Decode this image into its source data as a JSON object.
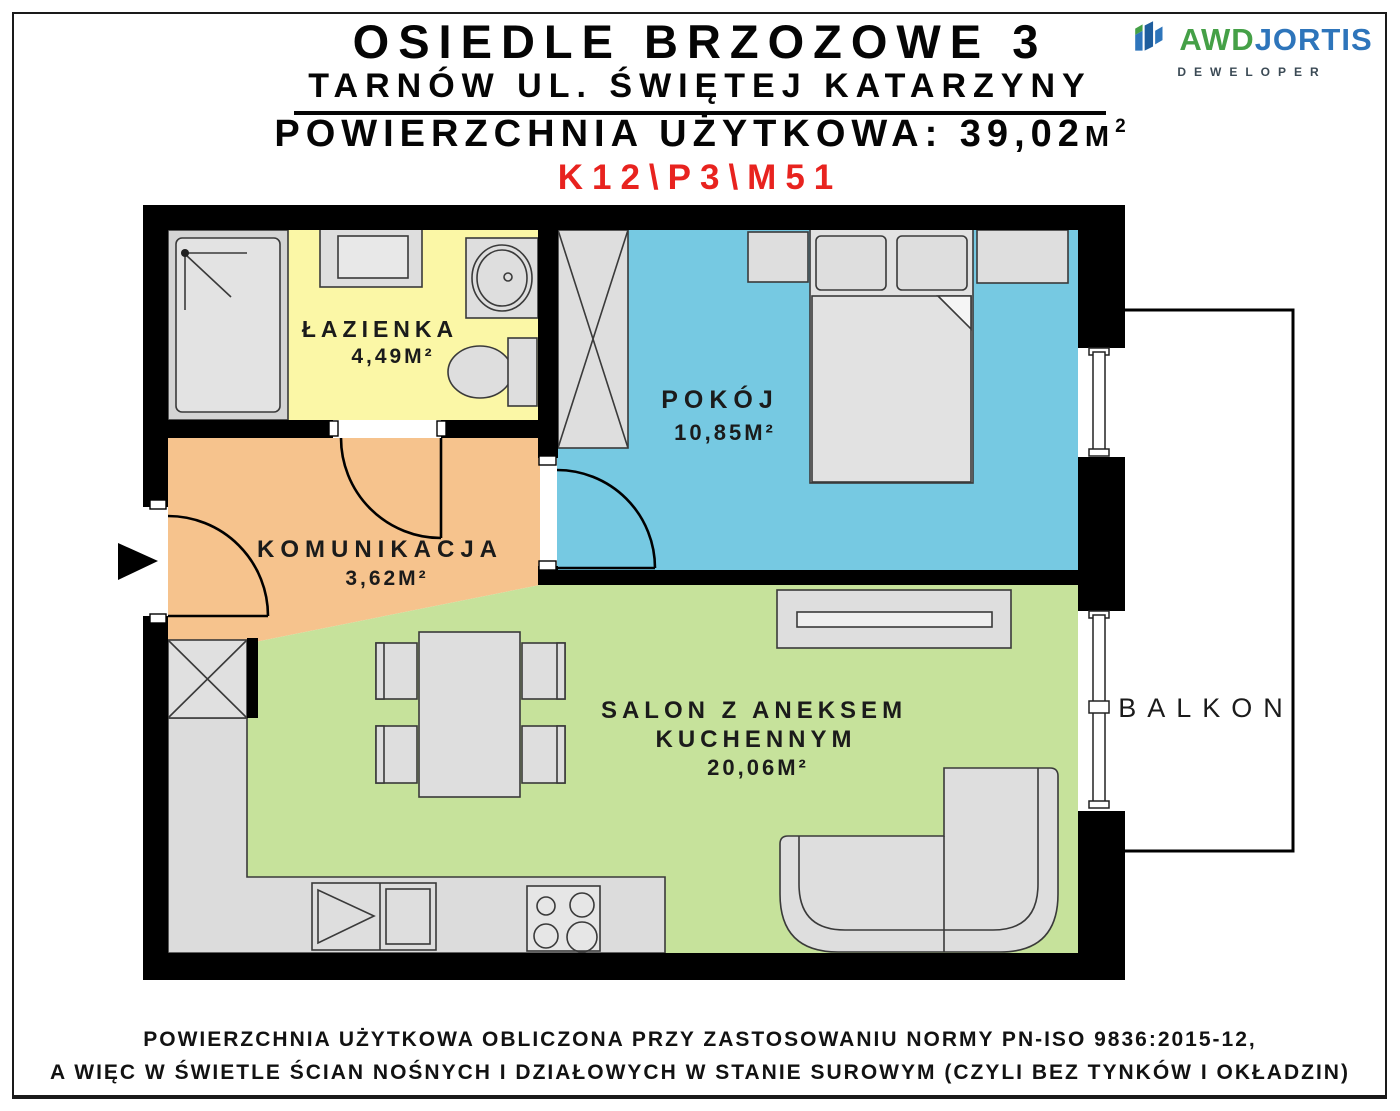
{
  "header": {
    "title": "OSIEDLE BRZOZOWE 3",
    "subtitle": "TARNÓW UL. ŚWIĘTEJ KATARZYNY",
    "area_label": "POWIERZCHNIA UŻYTKOWA: 39,02",
    "area_unit": "M",
    "area_exp": "2",
    "unit_code": "K12\\P3\\M51"
  },
  "logo": {
    "brand_a": "AWD",
    "brand_b": "JORTIS",
    "tagline": "DEWELOPER",
    "icon": "skyline-flag-icon",
    "color_green": "#45a047",
    "color_blue": "#2e75bb"
  },
  "rooms": {
    "lazienka": {
      "name": "ŁAZIENKA",
      "area": "4,49M²"
    },
    "pokoj": {
      "name": "POKÓJ",
      "area": "10,85M²"
    },
    "komunikacja": {
      "name": "KOMUNIKACJA",
      "area": "3,62M²"
    },
    "salon": {
      "name_line1": "SALON Z ANEKSEM",
      "name_line2": "KUCHENNYM",
      "area": "20,06M²"
    },
    "balkon": {
      "name": "BALKON"
    }
  },
  "colors": {
    "bathroom_fill": "#fbf7a6",
    "hall_fill": "#f6c38d",
    "bedroom_fill": "#76c9e2",
    "living_fill": "#c6e29b",
    "wall": "#000000",
    "furniture_fill": "#dedede",
    "unit_code_red": "#e8231f"
  },
  "footer": {
    "line1": "POWIERZCHNIA UŻYTKOWA OBLICZONA PRZY ZASTOSOWANIU NORMY PN-ISO 9836:2015-12,",
    "line2": "A WIĘC W ŚWIETLE ŚCIAN NOŚNYCH I DZIAŁOWYCH W STANIE SUROWYM (CZYLI BEZ TYNKÓW I OKŁADZIN)"
  }
}
